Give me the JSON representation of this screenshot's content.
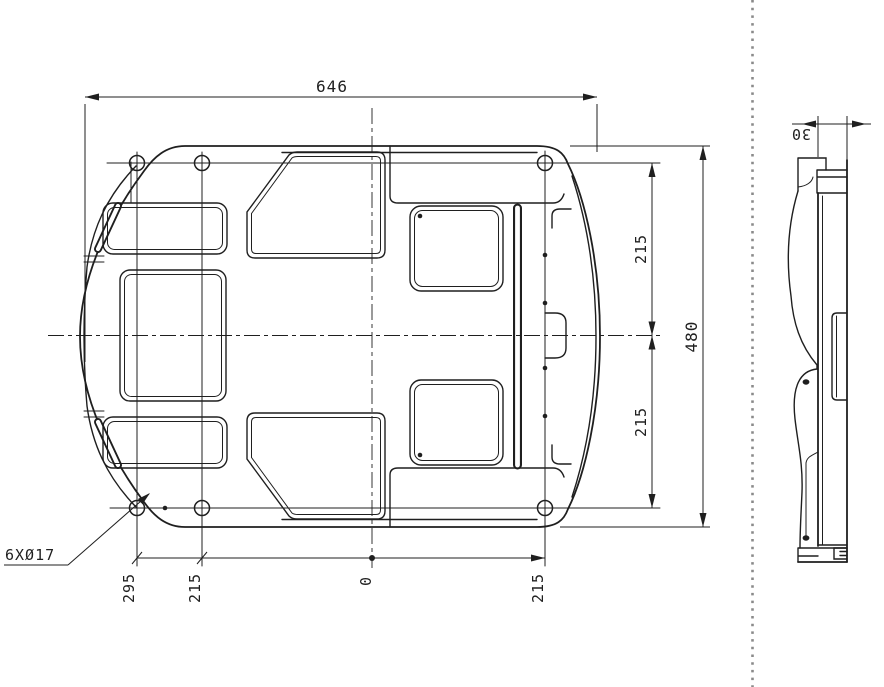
{
  "colors": {
    "line": "#1f1f1f",
    "background": "#ffffff",
    "separator": "#8a8a8a"
  },
  "plan_view": {
    "dim_width": "646",
    "dim_height": "480",
    "dim_offset_upper": "215",
    "dim_offset_lower": "215",
    "hole_callout": "6XØ17",
    "ordinates": {
      "col1": "295",
      "col2": "215",
      "col3": "0",
      "col4": "215"
    }
  },
  "side_view": {
    "dim_thickness": "30"
  }
}
